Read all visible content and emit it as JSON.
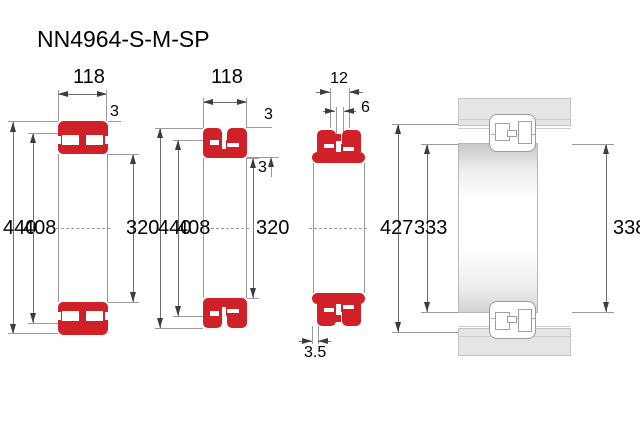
{
  "title": "NN4964-S-M-SP",
  "front_view": {
    "width": "118",
    "outer_diameter": "440",
    "recess_diameter": "408",
    "bore_diameter": "320",
    "rib": "3"
  },
  "mid_view": {
    "width": "118",
    "outer_diameter": "440",
    "recess_diameter": "408",
    "bore_diameter": "320",
    "rib_top": "3",
    "rib_bottom": "3"
  },
  "groove_view": {
    "groove_width": "12",
    "hole_diameter": "6",
    "outer_diameter": "427",
    "bore_diameter": "333",
    "step": "3.5"
  },
  "section_view": {
    "inner_diameter": "338"
  },
  "colors": {
    "bearing_red": "#d02028",
    "steel_gray": "#e5e5e5"
  }
}
